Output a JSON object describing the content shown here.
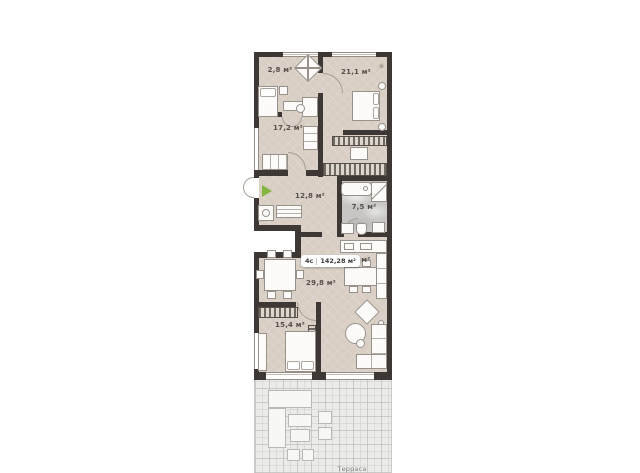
{
  "plan": {
    "badge": {
      "type": "4с",
      "area": "142,28 м²"
    },
    "rooms": {
      "closet": "2,8 м²",
      "bedroom_top": "21,1 м²",
      "bedroom_left": "17,2 м²",
      "hallway": "12,8 м²",
      "bathroom": "7,5 м²",
      "kitchen": "8,2 м²",
      "living": "29,8 м²",
      "bedroom_bottom": "15,4 м²",
      "terrace": "Терраса"
    },
    "colors": {
      "floor": "#d8cec4",
      "wall": "#3d3835",
      "terrace": "#ebebe9",
      "marble": "#c7c6c4",
      "accent_green": "#83b63e",
      "outline": "#97918a"
    }
  }
}
